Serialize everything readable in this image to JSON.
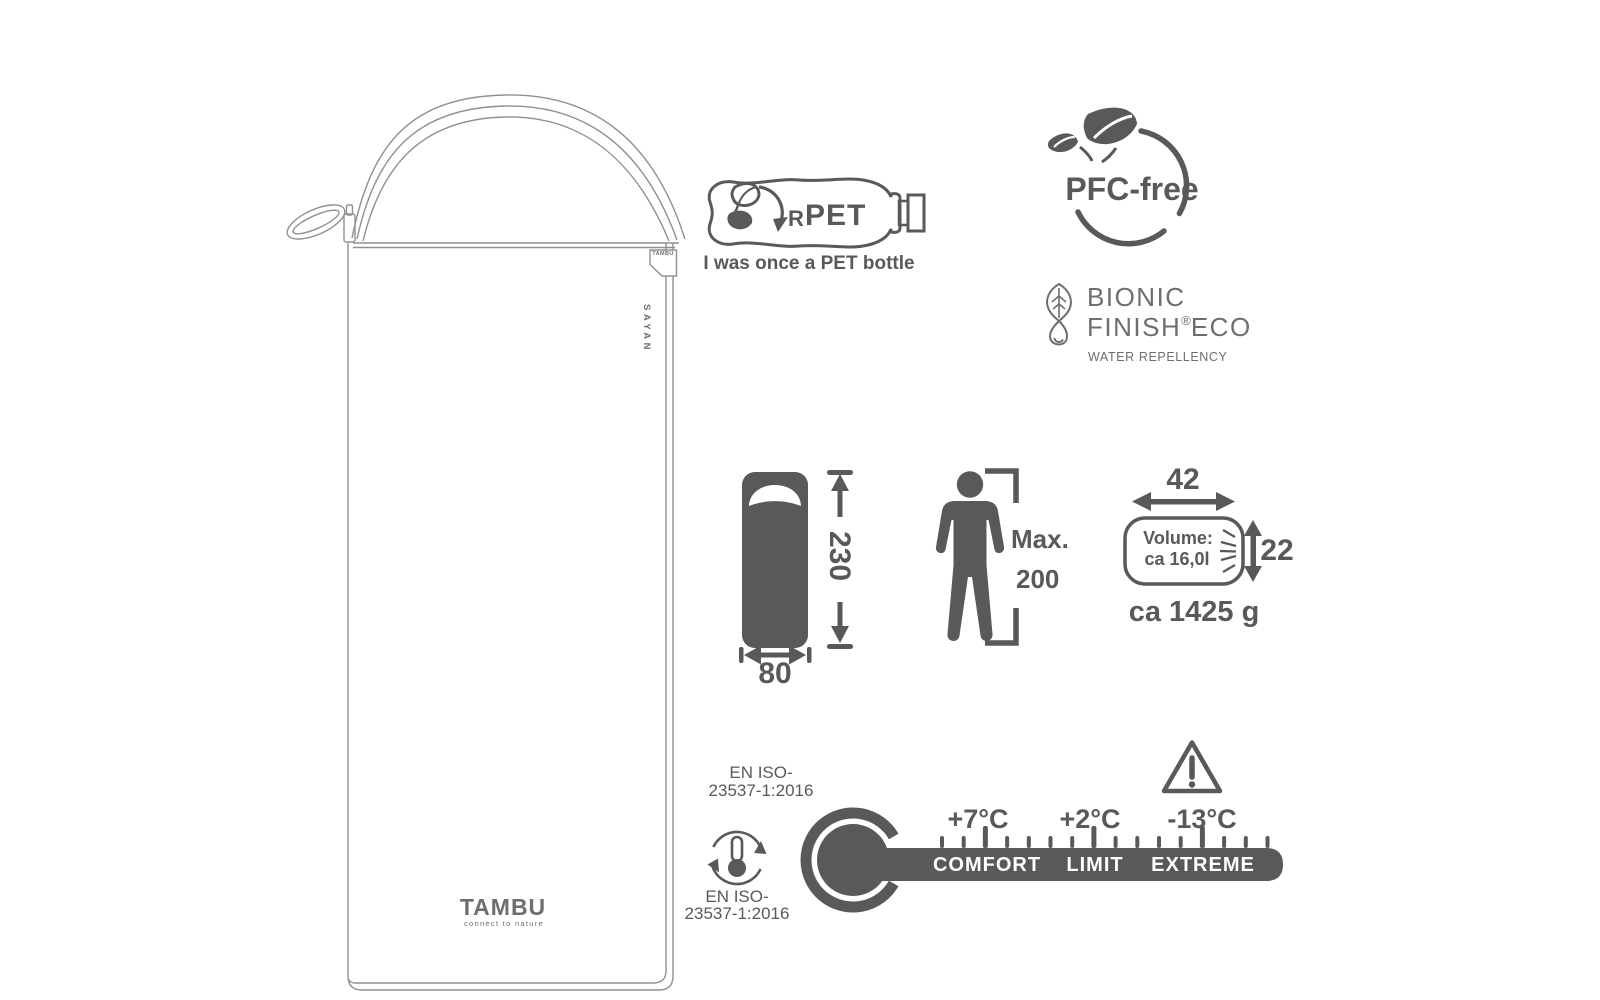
{
  "colors": {
    "ink": "#58595b",
    "line": "#8f9092",
    "soft": "#6d6e70",
    "bg": "#ffffff"
  },
  "product": {
    "corner_tag": "TAMBU",
    "name_vertical": "SAYAN",
    "logo": "TAMBU",
    "logo_tagline": "connect to nature"
  },
  "badges": {
    "rpet": {
      "r": "R",
      "pet": "PET",
      "caption": "I was once a PET bottle"
    },
    "pfc_free": {
      "label": "PFC-free"
    },
    "bionic_finish": {
      "word1": "BIONIC",
      "word2": "FINISH",
      "reg": "®",
      "word3": "ECO",
      "caption": "WATER REPELLENCY"
    }
  },
  "specs": {
    "length_cm": "230",
    "width_cm": "80",
    "person": {
      "label": "Max.",
      "value": "200"
    },
    "pack": {
      "width": "42",
      "height": "22",
      "volume_label": "Volume:",
      "volume_value": "ca 16,0l",
      "weight": "ca 1425 g"
    }
  },
  "temperature": {
    "standard_top": {
      "line1": "EN ISO-",
      "line2": "23537-1:2016"
    },
    "standard_icon": {
      "line1": "EN ISO-",
      "line2": "23537-1:2016"
    },
    "zones": [
      {
        "temp": "+7°C",
        "label": "COMFORT"
      },
      {
        "temp": "+2°C",
        "label": "LIMIT"
      },
      {
        "temp": "-13°C",
        "label": "EXTREME"
      }
    ]
  },
  "icons": {
    "rpet-bottle-icon": "outline PET bottle with recycling leaf arrow",
    "pfc-leaves-icon": "two leaves over a circle",
    "bionic-leaf-drop-icon": "leaf with water drop",
    "sleeping-bag-icon": "filled sleeping bag silhouette",
    "person-icon": "standing person with height brackets",
    "pack-sack-icon": "packed stuff sack",
    "thermometer-cycle-icon": "thermometer inside circular arrows",
    "thermometer-scale-icon": "thermometer bulb with rating bar",
    "warning-icon": "triangle with exclamation mark"
  }
}
